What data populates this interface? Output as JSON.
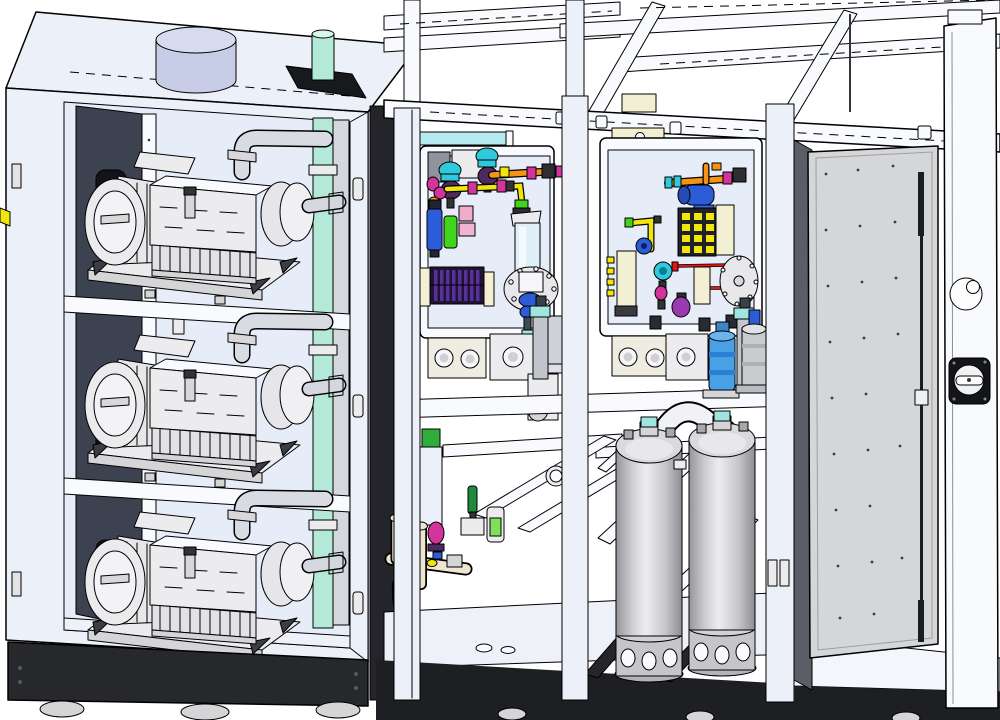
{
  "scene": {
    "label": "Isometric 3D CAD rendering of a modular industrial vacuum pump and gas processing system: left pump cabinet with three stacked vacuum pumps, center process skid with two colorful instrument valve panels and two vertical filter tanks, right electrical cabinet with open door"
  },
  "colors": {
    "background": "#ffffff",
    "outline": "#000000",
    "frame_white": "#f8fafe",
    "frame_light": "#ecf0f9",
    "frame_mid": "#dde4f2",
    "interior": "#e6ecf8",
    "dark_wall": "#3d4250",
    "near_black": "#17191d",
    "base_black": "#1d1f22",
    "metal_light": "#ececef",
    "metal_mid": "#d5d5d8",
    "metal_dark": "#a8a8ac",
    "teal_pipe": "#b4e9d7",
    "teal_cap": "#9fe5df",
    "lavender_duct": "#c7cde7",
    "cream_pipe": "#efe6d2",
    "beige_plate": "#f3efd3",
    "glass_blue": "#dff0f8",
    "pipe_gray": "#d8dce2",
    "orange": "#f49314",
    "yellow": "#f2e50a",
    "cyan": "#2fc8dc",
    "magenta": "#d2349b",
    "red": "#e51511",
    "green_bright": "#41d41d",
    "green_dark": "#1d8a3c",
    "blue_filter": "#2d5cd8",
    "blue_actuator": "#4aa0e6",
    "purple_coil": "#57309b",
    "violet": "#9a3bb0",
    "dark_purple": "#4f2a5e",
    "door_gray": "#d5d6d8",
    "hinge_gray": "#5b5e66"
  },
  "modules": {
    "left_cabinet": {
      "name": "pump cabinet",
      "components": [
        "exhaust duct collar",
        "teal exhaust riser pipe",
        "gray exhaust pipe",
        "side wall vent slots",
        "upper vacuum pump",
        "middle vacuum pump",
        "lower vacuum pump",
        "pump shelves",
        "black base plinth",
        "leveling feet"
      ]
    },
    "center_module": {
      "name": "process skid",
      "components": [
        "left instrument panel",
        "right instrument panel",
        "orange gas line",
        "yellow gas line",
        "red gas line",
        "cyan shutoff valves",
        "magenta fittings",
        "blue filter housing",
        "purple heater coil",
        "sight glass",
        "yellow valve manifold block",
        "cyan pressure gauge",
        "blue valve actuator",
        "hanging filter cartridges",
        "left vertical filter tank",
        "right vertical filter tank",
        "s-bend exhaust pipe",
        "blue cylinder valve",
        "gray filter cylinder",
        "cream drain piping",
        "green handle valve",
        "flow sensor with green label",
        "diagonal frame braces"
      ]
    },
    "right_cabinet": {
      "name": "electrical cabinet",
      "components": [
        "open door panel",
        "door stud dots",
        "door lock rod",
        "door latch",
        "hinge strip",
        "main disconnect switch",
        "circular knockout",
        "black base"
      ]
    }
  }
}
